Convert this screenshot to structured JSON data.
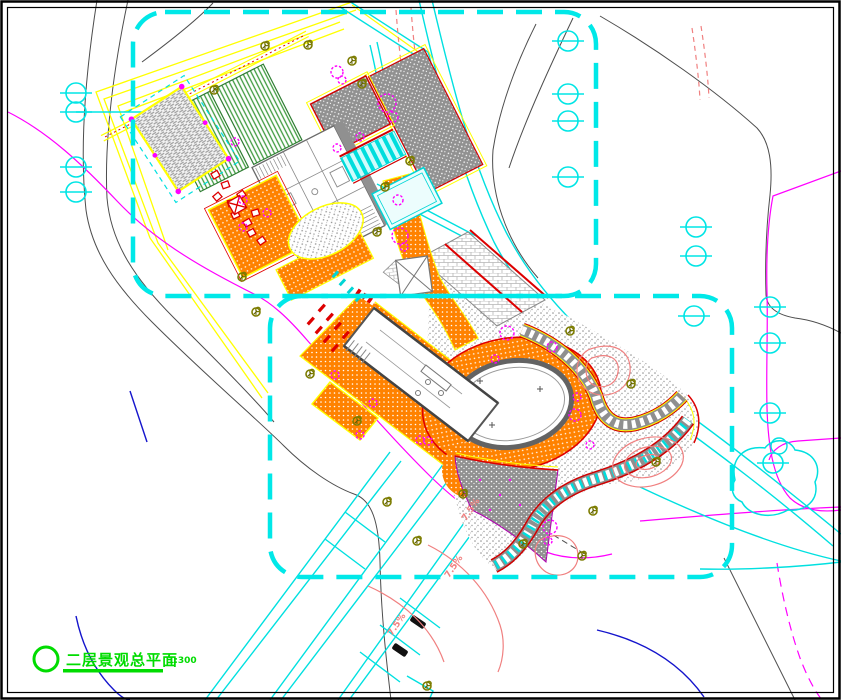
{
  "drawing": {
    "title": "二层景观总平面",
    "scale": "1:300",
    "colors": {
      "boundary_dash": "#00E8E8",
      "road_cyan": "#00E0E0",
      "contour_gray": "#4d4d4d",
      "site_line_magenta": "#FF00FF",
      "water_blue": "#1414CC",
      "paving_orange": "#FF8200",
      "roof_stripe_green": "#3F9B3F",
      "accent_red": "#DD0000",
      "trim_yellow": "#FFFF00",
      "plant_olive": "#7C7C00",
      "label_pink": "#F08080",
      "title_green": "#00DC00"
    },
    "slope_labels": [
      {
        "text": "7.5%",
        "x": 473,
        "y": 511,
        "angle": -56
      },
      {
        "text": "7.5%",
        "x": 456,
        "y": 568,
        "angle": -56
      },
      {
        "text": "7.5%",
        "x": 399,
        "y": 626,
        "angle": -56
      }
    ],
    "benchmarks": [
      [
        76,
        93
      ],
      [
        76,
        112
      ],
      [
        76,
        167
      ],
      [
        76,
        192
      ],
      [
        568,
        41
      ],
      [
        568,
        94
      ],
      [
        568,
        121
      ],
      [
        568,
        177
      ],
      [
        696,
        227
      ],
      [
        696,
        256
      ],
      [
        694,
        316
      ],
      [
        770,
        307
      ],
      [
        770,
        343
      ],
      [
        770,
        413
      ],
      [
        773,
        463
      ]
    ],
    "trees": [
      [
        308,
        45
      ],
      [
        352,
        61
      ],
      [
        362,
        84
      ],
      [
        214,
        90
      ],
      [
        265,
        46
      ],
      [
        410,
        161
      ],
      [
        385,
        187
      ],
      [
        377,
        232
      ],
      [
        242,
        277
      ],
      [
        256,
        312
      ],
      [
        310,
        374
      ],
      [
        357,
        421
      ],
      [
        387,
        502
      ],
      [
        417,
        541
      ],
      [
        463,
        494
      ],
      [
        523,
        544
      ],
      [
        593,
        511
      ],
      [
        582,
        556
      ],
      [
        427,
        686
      ],
      [
        570,
        331
      ],
      [
        631,
        384
      ],
      [
        656,
        462
      ]
    ],
    "shrubs": [
      [
        337,
        72,
        6
      ],
      [
        342,
        80,
        4
      ],
      [
        387,
        103,
        9
      ],
      [
        393,
        117,
        5
      ],
      [
        235,
        142,
        4
      ],
      [
        243,
        200,
        4
      ],
      [
        267,
        213,
        4
      ],
      [
        243,
        227,
        4
      ],
      [
        360,
        137,
        4
      ],
      [
        337,
        148,
        4
      ],
      [
        398,
        200,
        5
      ],
      [
        400,
        236,
        8
      ],
      [
        404,
        247,
        4
      ],
      [
        507,
        333,
        7
      ],
      [
        552,
        347,
        5
      ],
      [
        495,
        359,
        4
      ],
      [
        577,
        397,
        4
      ],
      [
        335,
        375,
        4
      ],
      [
        373,
        403,
        4
      ],
      [
        420,
        440,
        4
      ],
      [
        360,
        435,
        4
      ],
      [
        550,
        527,
        7
      ],
      [
        548,
        541,
        4
      ],
      [
        575,
        415,
        6
      ],
      [
        590,
        445,
        4
      ],
      [
        428,
        441,
        4
      ]
    ]
  }
}
